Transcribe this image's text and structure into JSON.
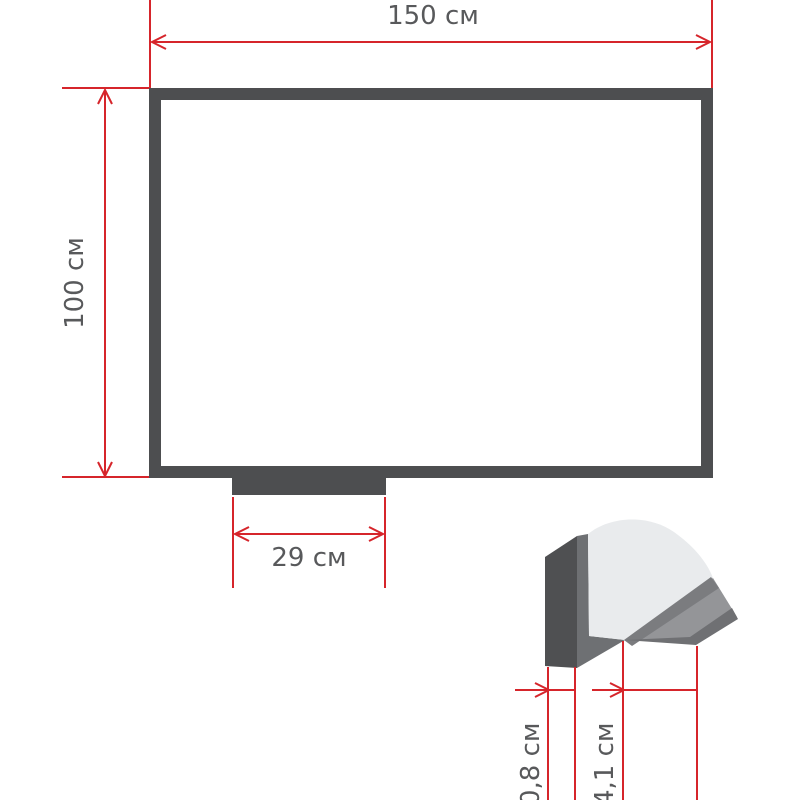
{
  "diagram": {
    "front_view": {
      "width_label": "150 см",
      "height_label": "100 см",
      "tray_width_label": "29 см"
    },
    "profile_detail": {
      "frame_depth_label": "0,8 см",
      "tray_depth_label": "4,1 см"
    },
    "colors": {
      "dimension_red": "#d6252b",
      "frame_dark": "#4d4e50",
      "profile_frame_face": "#4f5052",
      "profile_frame_inner": "#6e7073",
      "board_surface_light": "#e9ebed",
      "tray_surface_gray": "#949598",
      "tray_edge_dark": "#7b7c7f",
      "label_text_gray": "#58595b",
      "background": "#ffffff"
    }
  }
}
